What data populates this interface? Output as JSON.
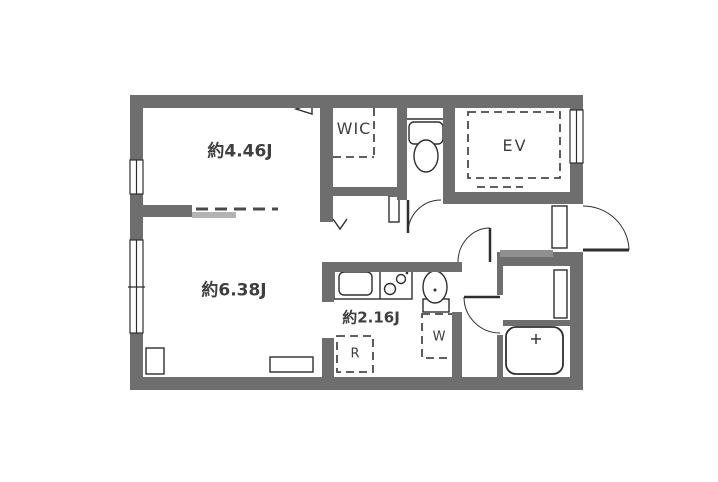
{
  "plan": {
    "type": "floor-plan",
    "rooms": {
      "bedroom": {
        "label": "約4.46J"
      },
      "living": {
        "label": "約6.38J"
      },
      "kitchen": {
        "label": "約2.16J"
      },
      "wic": {
        "label": "WIC"
      },
      "elevator": {
        "label": "EV"
      },
      "washer_spot": {
        "label": "W"
      },
      "fridge_spot": {
        "label": "R"
      }
    }
  },
  "colors": {
    "bg": "#ffffff",
    "wall": "#6e6e6e",
    "line": "#2e2e2e",
    "dash": "#4a4a4a",
    "text": "#3f3f3f",
    "slide-bar": "#b3b3b3",
    "step": "#8f8f8f"
  }
}
